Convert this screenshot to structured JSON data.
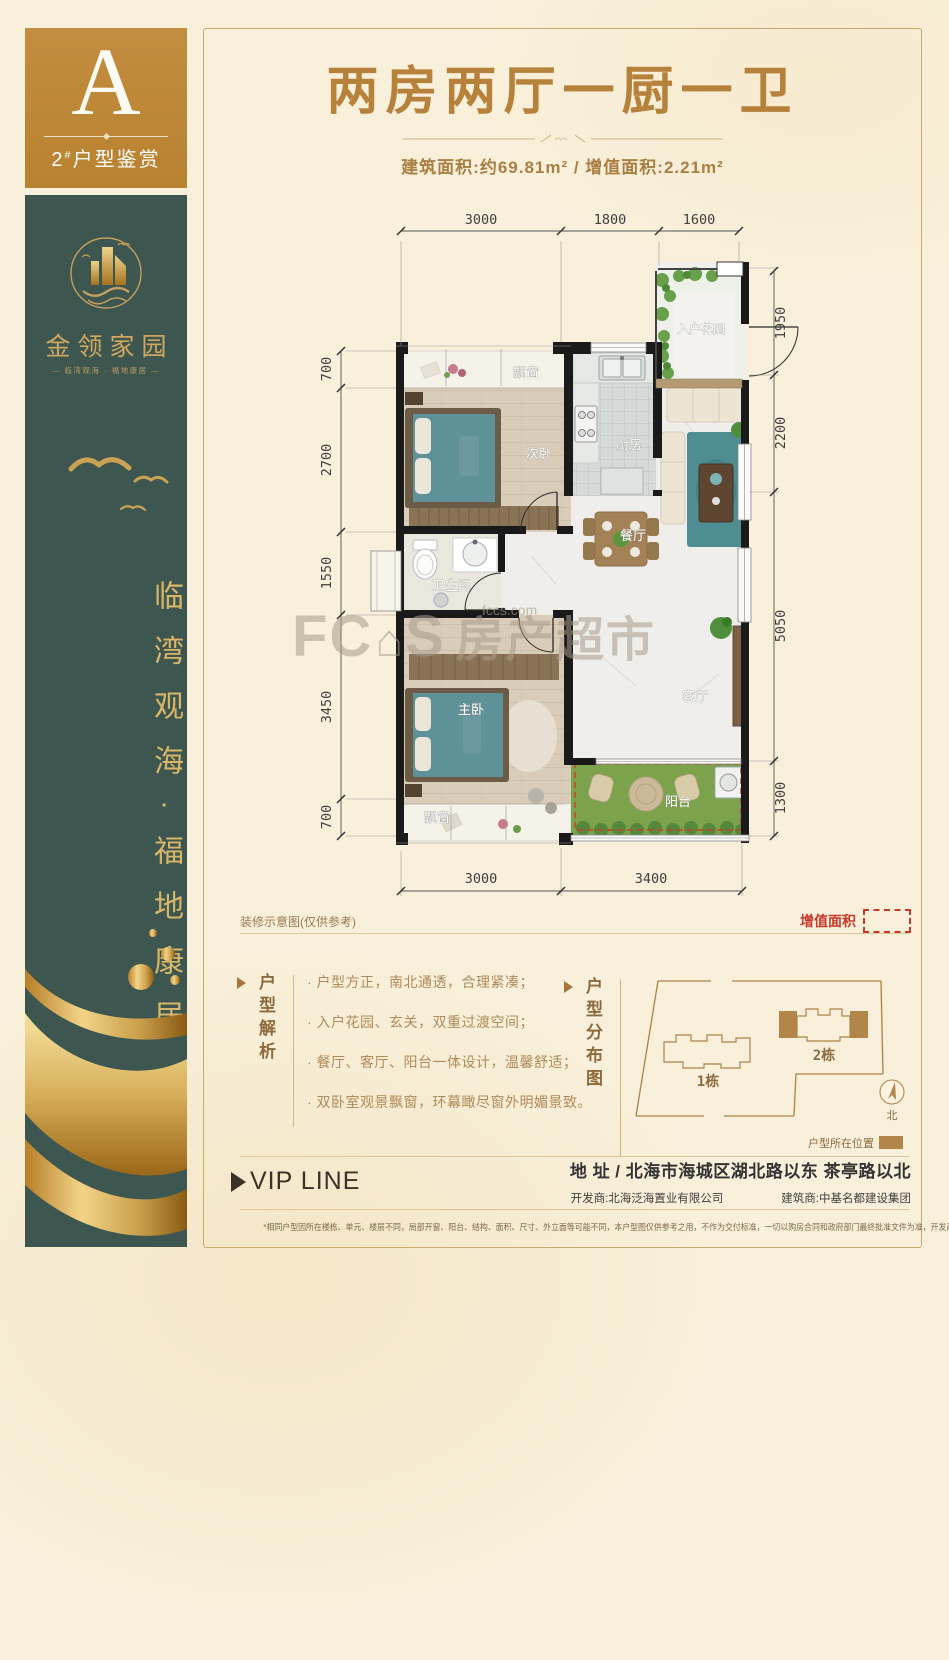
{
  "colors": {
    "gold": "#bf8a3c",
    "teal": "#3d5650",
    "title_gold": "#b5813b",
    "text_brown": "#b08a58",
    "red": "#c7392b",
    "dark_text": "#3c3126"
  },
  "sidebar": {
    "unit_letter": "A",
    "unit_caption_num": "2",
    "unit_caption_hash": "#",
    "unit_caption_text": "户型鉴赏",
    "logo_name": "金领家园",
    "logo_tagline": "— 临湾观海 · 福地康居 —",
    "slogan": "临湾观海·福地康居"
  },
  "header": {
    "title": "两房两厅一厨一卫",
    "area_line": "建筑面积:约69.81m² / 增值面积:2.21m²"
  },
  "floorplan": {
    "note": "装修示意图(仅供参考)",
    "legend_added_area": "增值面积",
    "rooms": {
      "bay_top": "飘窗",
      "second_bedroom": "次卧",
      "kitchen": "厨房",
      "entry_garden": "入户花园",
      "bathroom": "卫生间",
      "dining": "餐厅",
      "living": "客厅",
      "master_bedroom": "主卧",
      "balcony": "阳台",
      "bay_bottom": "飘窗"
    },
    "dims": {
      "top": [
        "3000",
        "1800",
        "1600"
      ],
      "bottom": [
        "3000",
        "3400"
      ],
      "left": [
        "700",
        "2700",
        "1550",
        "3450",
        "700"
      ],
      "right": [
        "1950",
        "2200",
        "5050",
        "1300"
      ]
    }
  },
  "analysis": {
    "label": "户型解析",
    "bullets": [
      "· 户型方正，南北通透，合理紧凑；",
      "· 入户花园、玄关，双重过渡空间；",
      "· 餐厅、客厅、阳台一体设计，温馨舒适；",
      "· 双卧室观景飘窗，环幕瞰尽窗外明媚景致。"
    ]
  },
  "distribution": {
    "label": "户型分布图",
    "building1": "1栋",
    "building2": "2栋",
    "north": "北",
    "legend": "户型所在位置"
  },
  "footer": {
    "vip_line": "VIP LINE",
    "address_label": "地  址 /",
    "address": "北海市海城区湖北路以东  茶亭路以北",
    "developer": "开发商:北海泛海置业有限公司",
    "builder": "建筑商:中基名都建设集团",
    "disclaimer": "*相同户型因所在楼栋、单元、楼层不同，局部开窗、阳台、结构、面积、尺寸、外立面等可能不同，本户型图仅供参考之用，不作为交付标准，一切以购房合同和政府部门最终批准文件为准，开发商保留最终解释权。"
  },
  "watermark": {
    "f": "FC",
    "house_icon": "⌂",
    "s": "S",
    "cn": "房产超市",
    "site": "fccs.com"
  }
}
